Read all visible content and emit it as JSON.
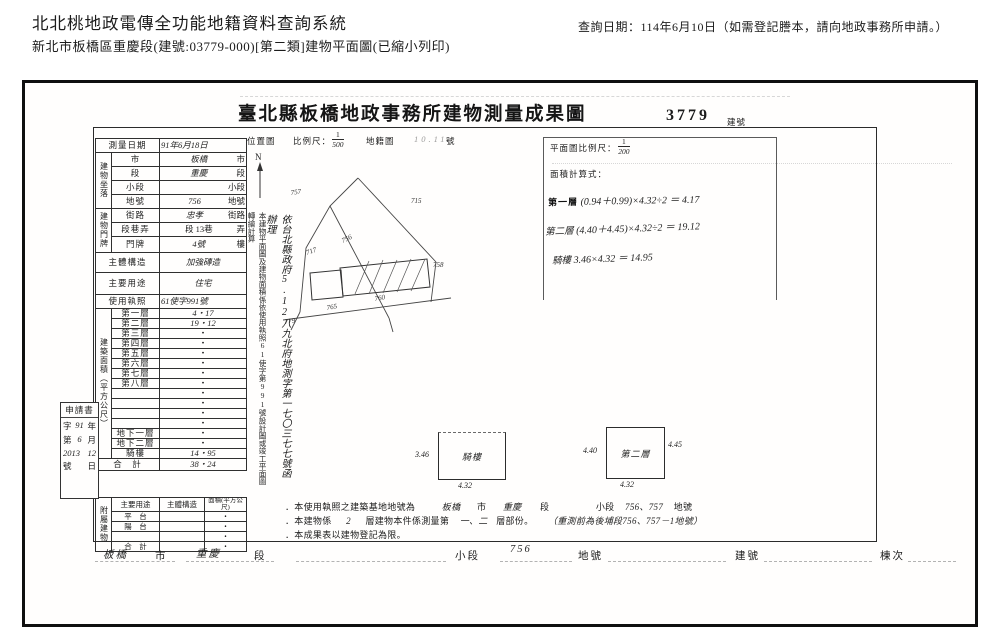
{
  "header": {
    "system_title": "北北桃地政電傳全功能地籍資料查詢系統",
    "subtitle": "新北市板橋區重慶段(建號:03779-000)[第二類]建物平面圖(已縮小列印)",
    "query_date": "查詢日期：114年6月10日（如需登記謄本，請向地政事務所申請。）"
  },
  "document": {
    "title": "臺北縣板橋地政事務所建物測量成果圖",
    "building_no": "3779",
    "building_no_label": "建號"
  },
  "survey": {
    "survey_date_label": "測量日期",
    "survey_date_value": "91年6月18日",
    "location_group": "建物坐落",
    "loc": [
      {
        "label": "市",
        "value": "板橋",
        "suffix": "市"
      },
      {
        "label": "段",
        "value": "重慶",
        "suffix": "段"
      },
      {
        "label": "小段",
        "value": "",
        "suffix": "小段"
      },
      {
        "label": "地號",
        "value": "756",
        "suffix": "地號"
      }
    ],
    "address_group": "建物門牌",
    "addr": [
      {
        "label": "街路",
        "value": "忠孝",
        "suffix": "街路"
      },
      {
        "label": "段巷弄",
        "value": "段 13巷",
        "suffix": "弄"
      },
      {
        "label": "門牌",
        "value": "4號",
        "suffix": "樓"
      }
    ],
    "structure_label": "主體構造",
    "structure_value": "加強磚造",
    "use_label": "主要用途",
    "use_value": "住宅",
    "license_label": "使用執照",
    "license_value": "61使字991號",
    "area_group": "建築面積（平方公尺）",
    "floors": [
      {
        "label": "第一層",
        "value": "4・17"
      },
      {
        "label": "第二層",
        "value": "19・12"
      },
      {
        "label": "第三層",
        "value": "・"
      },
      {
        "label": "第四層",
        "value": "・"
      },
      {
        "label": "第五層",
        "value": "・"
      },
      {
        "label": "第六層",
        "value": "・"
      },
      {
        "label": "第七層",
        "value": "・"
      },
      {
        "label": "第八層",
        "value": "・"
      },
      {
        "label": "",
        "value": "・"
      },
      {
        "label": "",
        "value": "・"
      },
      {
        "label": "",
        "value": "・"
      },
      {
        "label": "",
        "value": "・"
      },
      {
        "label": "地下一層",
        "value": "・"
      },
      {
        "label": "地下二層",
        "value": "・"
      },
      {
        "label": "騎樓",
        "value": "14・95"
      }
    ],
    "total_label": "合　計",
    "total_value": "38・24",
    "annex_group": "附屬建物",
    "annex_headers": [
      "主要用途",
      "主體構造",
      "面積(平方公尺)"
    ],
    "annex": [
      {
        "label": "平　台",
        "structure": "",
        "area": "・"
      },
      {
        "label": "陽　台",
        "structure": "",
        "area": "・"
      },
      {
        "label": "",
        "structure": "",
        "area": "・"
      },
      {
        "label": "合　計",
        "structure": "",
        "area": "・"
      }
    ]
  },
  "application": {
    "label": "申請書",
    "l1p": "字",
    "l1h": "91",
    "l1s": "年",
    "l2p": "第",
    "l2h": "6",
    "l2s": "月",
    "l3h": "2013",
    "l3h2": "12",
    "l4p": "號",
    "l4s": "日"
  },
  "map": {
    "label": "位置圖",
    "scale_label": "比例尺：",
    "scale_num": "1",
    "scale_den": "500",
    "cadastral_label": "地籍圖",
    "cadastral_value": "10.11",
    "no_suffix": "號",
    "north": "N",
    "parcels": [
      "757",
      "715",
      "756",
      "717",
      "758",
      "765",
      "760",
      "779"
    ]
  },
  "plan": {
    "scale_label": "平面圖比例尺：",
    "scale_num": "1",
    "scale_den": "200",
    "formula_label": "面積計算式：",
    "formulas": [
      {
        "label": "第一層",
        "expr": "(0.94＋0.99)×4.32÷2 ＝ 4.17"
      },
      {
        "label": "第二層",
        "expr": "(4.40＋4.45)×4.32÷2 ＝ 19.12"
      },
      {
        "label": "騎樓",
        "expr": "3.46×4.32 ＝ 14.95"
      }
    ],
    "qilou": {
      "label": "騎樓",
      "left": "3.46",
      "bottom": "4.32"
    },
    "second": {
      "label": "第二層",
      "left": "4.40",
      "right": "4.45",
      "bottom": "4.32"
    }
  },
  "vertical_notes": {
    "printed": "本建物平面圖及建物面積係依使用執照61使字第991號設計圖或竣工平面圖轉繪計算",
    "handwritten": "依台北縣政府5.12八九北府地測字第一七〇三七七號函辦理"
  },
  "notes": {
    "n1_prefix": "．本使用執照之建築基地地號為",
    "n1_city": "板橋",
    "n1_city_s": "市",
    "n1_sec": "重慶",
    "n1_sec_s": "段",
    "n1_sub": "小段",
    "n1_nums": "756、757",
    "n1_suffix": "地號",
    "n2_prefix": "．本建物係",
    "n2_floors": "2",
    "n2_mid": "層建物本件係測量第",
    "n2_measured": "一、二",
    "n2_suffix": "層部份。",
    "n2_hand": "（重測前為後埔段756、757－1地號）",
    "n3": "．本成果表以建物登記為限。"
  },
  "footer": {
    "city": "板橋",
    "city_s": "市",
    "sec": "重慶",
    "sec_s": "段",
    "sub": "小段",
    "parcel": "756",
    "parcel_s": "地號",
    "bno": "建號",
    "unit": "棟次"
  }
}
